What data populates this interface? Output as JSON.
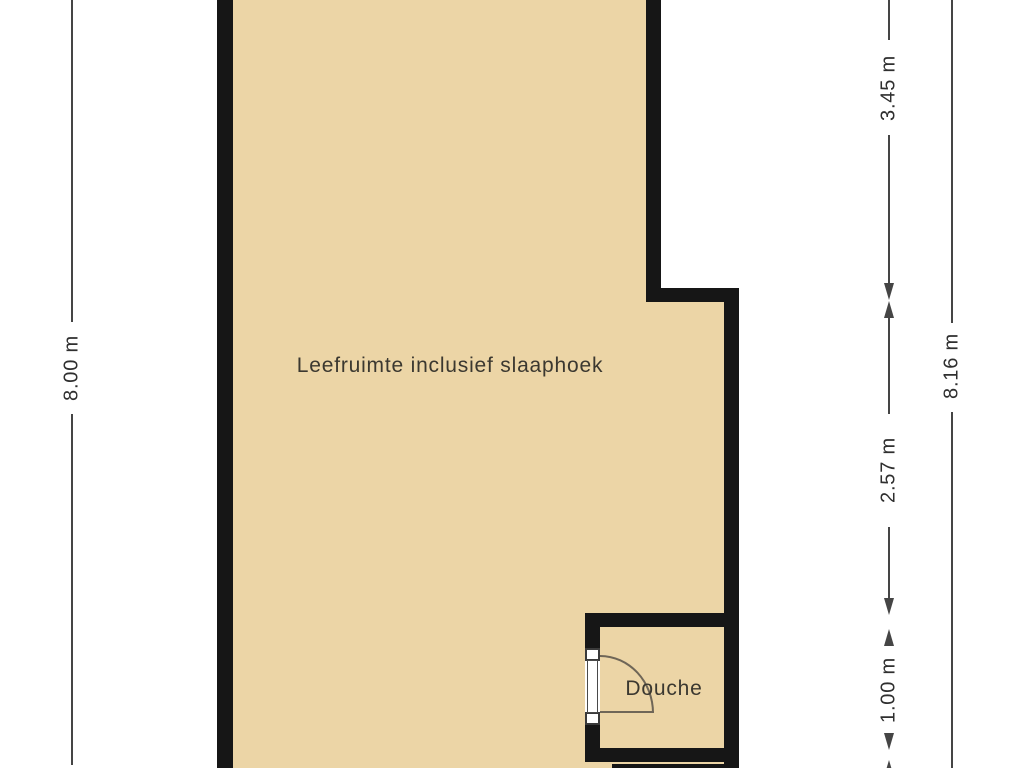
{
  "labels": {
    "main_room": "Leefruimte inclusief slaaphoek",
    "douche": "Douche"
  },
  "dimensions": {
    "left_total": "8.00 m",
    "right_segments": {
      "top": "3.45 m",
      "middle": "2.57 m",
      "bottom": "1.00 m"
    },
    "right_total": "8.16 m"
  },
  "theme": {
    "room_fill": "#ECD5A6",
    "wall": "#161616",
    "dim_line": "#454545",
    "dim_text": "#2f2f2f",
    "label_text": "#3b3830",
    "door_arc": "#6f6657",
    "background": "#ffffff"
  }
}
